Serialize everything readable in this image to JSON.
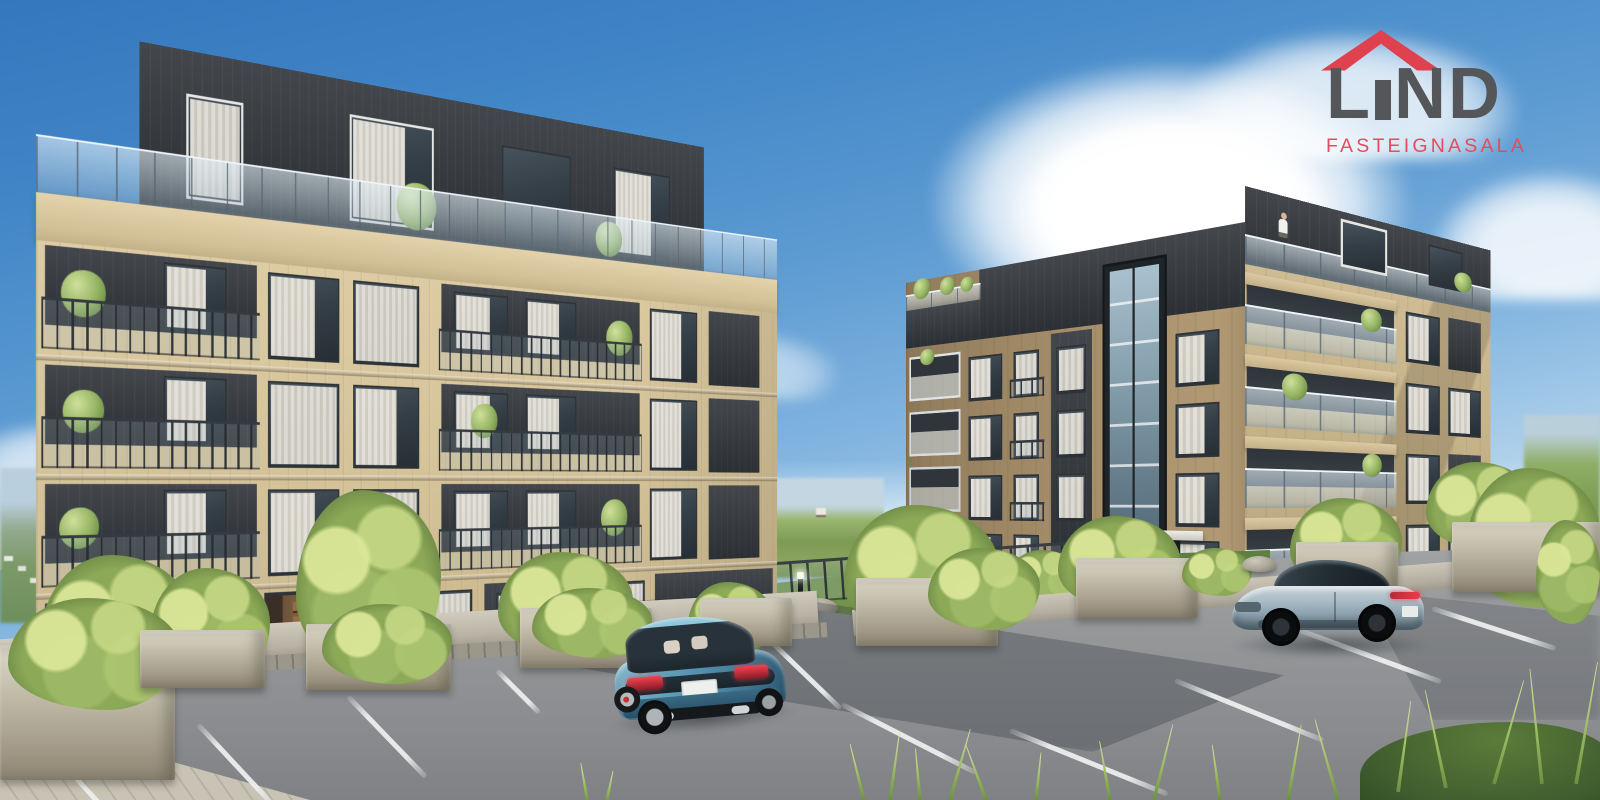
{
  "logo": {
    "title": "LIND",
    "title_parts": [
      "L",
      "I",
      "ND"
    ],
    "subtitle": "FASTEIGNASALA",
    "colors": {
      "roof": "#e0414f",
      "title": "#55565a",
      "subtitle": "#e9495c"
    }
  },
  "scene": {
    "type": "architectural_rendering",
    "subject": "Two modern apartment buildings with dark penthouse levels, balconies, landscaped courtyard and foreground parking lot",
    "sky": {
      "top": "#3577bd",
      "mid": "#6ba6d8",
      "horizon": "#d8eaf6",
      "clouds": "#ffffff"
    },
    "buildings": {
      "left": {
        "floors": 5,
        "facade": "#d6c49c",
        "penthouse_cladding": "#3c4044",
        "balcony_railings": "dark metal bars",
        "roof_terrace_railing": "glass"
      },
      "right": {
        "floors": 5,
        "facade": "#b09a74",
        "penthouse_cladding": "#42464a",
        "balcony_railings": "glass panels",
        "feature": "glazed elevator shaft",
        "detail": "person standing on top balcony"
      }
    },
    "vehicles": [
      {
        "name": "teal-blue sedan",
        "color": "#5e9cb8",
        "view": "rear three-quarter"
      },
      {
        "name": "slate-blue coupe",
        "color": "#9fb2bd",
        "view": "side, red tail-light strip"
      }
    ],
    "ground": {
      "asphalt": "#919394",
      "marking": "#eef0f0",
      "sidewalk": "#c2bcab",
      "lawn": "#70904c",
      "foliage": "#9cb668"
    }
  }
}
